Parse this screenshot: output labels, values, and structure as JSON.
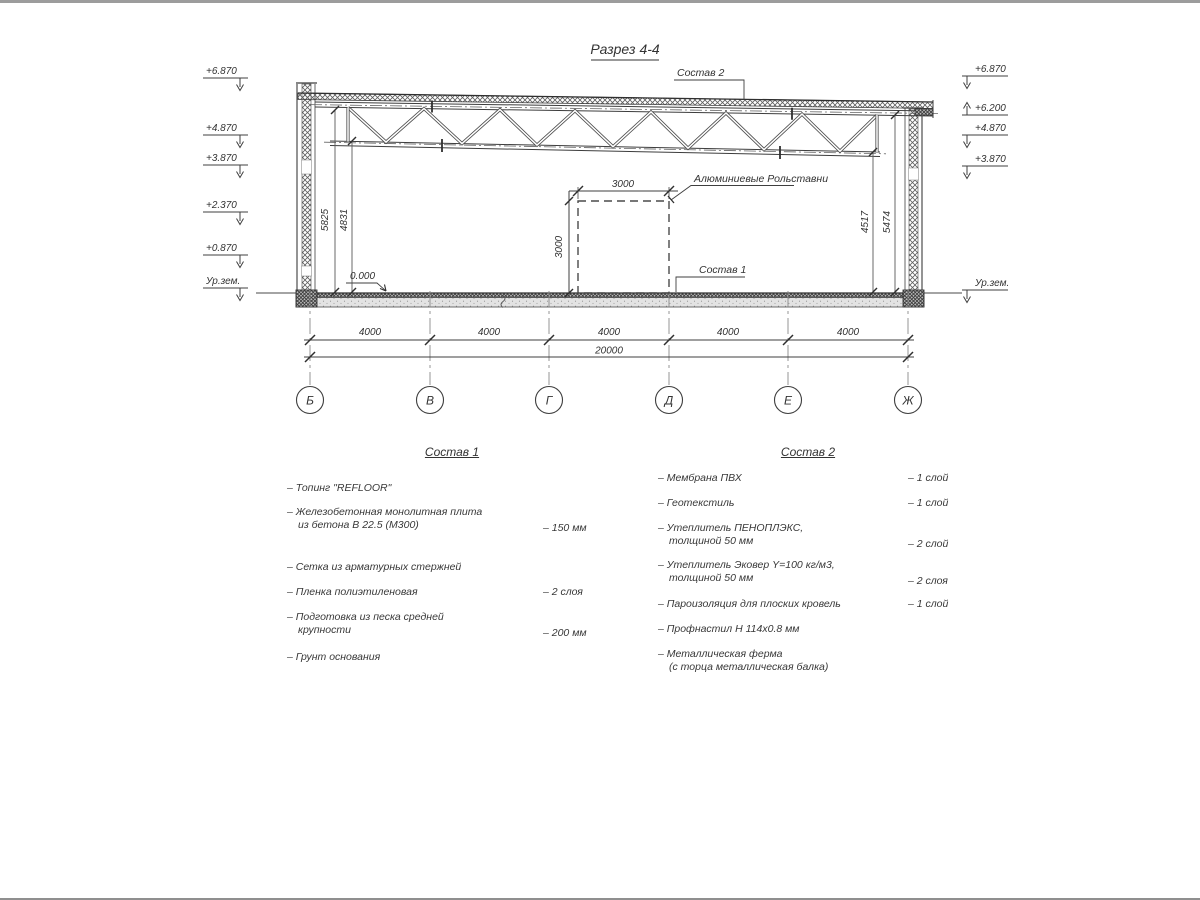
{
  "drawing": {
    "title": "Разрез 4-4",
    "callouts": {
      "sostav2": "Состав 2",
      "sostav1": "Состав 1",
      "shutters": "Алюминиевые Рольставни",
      "zero": "0.000"
    },
    "elev_left": [
      "+6.870",
      "+4.870",
      "+3.870",
      "+2.370",
      "+0.870",
      "Ур.зем."
    ],
    "elev_right": [
      "+6.870",
      "+6.200",
      "+4.870",
      "+3.870",
      "Ур.зем."
    ],
    "vdims_left": [
      "5825",
      "4831"
    ],
    "vdims_right": [
      "4517",
      "5474"
    ],
    "door": {
      "w": "3000",
      "h": "3000"
    },
    "bays": [
      "4000",
      "4000",
      "4000",
      "4000",
      "4000"
    ],
    "total": "20000",
    "axes": [
      "Б",
      "В",
      "Г",
      "Д",
      "Е",
      "Ж"
    ]
  },
  "sostav1": {
    "title": "Состав 1",
    "items": [
      {
        "t1": "– Топинг \"REFLOOR\""
      },
      {
        "t1": "– Железобетонная  монолитная плита",
        "t2": "из бетона В 22.5 (М300)",
        "val": "– 150 мм"
      },
      {
        "t1": "– Сетка из арматурных стержней"
      },
      {
        "t1": "– Пленка полиэтиленовая",
        "val": "–  2 слоя"
      },
      {
        "t1": "– Подготовка из песка средней",
        "t2": "крупности",
        "val": "– 200 мм"
      },
      {
        "t1": "– Грунт основания"
      }
    ]
  },
  "sostav2": {
    "title": "Состав 2",
    "items": [
      {
        "t1": "– Мембрана ПВХ",
        "val": "– 1 слой"
      },
      {
        "t1": "– Геотекстиль",
        "val": "– 1 слой"
      },
      {
        "t1": "– Утеплитель ПЕНОПЛЭКС,",
        "t2": "толщиной 50 мм",
        "val": "– 2 слой"
      },
      {
        "t1": "– Утеплитель Эковер Y=100 кг/м3,",
        "t2": "толщиной 50 мм",
        "val": "– 2 слоя"
      },
      {
        "t1": "– Пароизоляция для плоских кровель",
        "val": "– 1 слой"
      },
      {
        "t1": "– Профнастил Н 114х0.8 мм"
      },
      {
        "t1": "– Металлическая ферма",
        "t2": "(с торца металлическая балка)"
      }
    ]
  }
}
